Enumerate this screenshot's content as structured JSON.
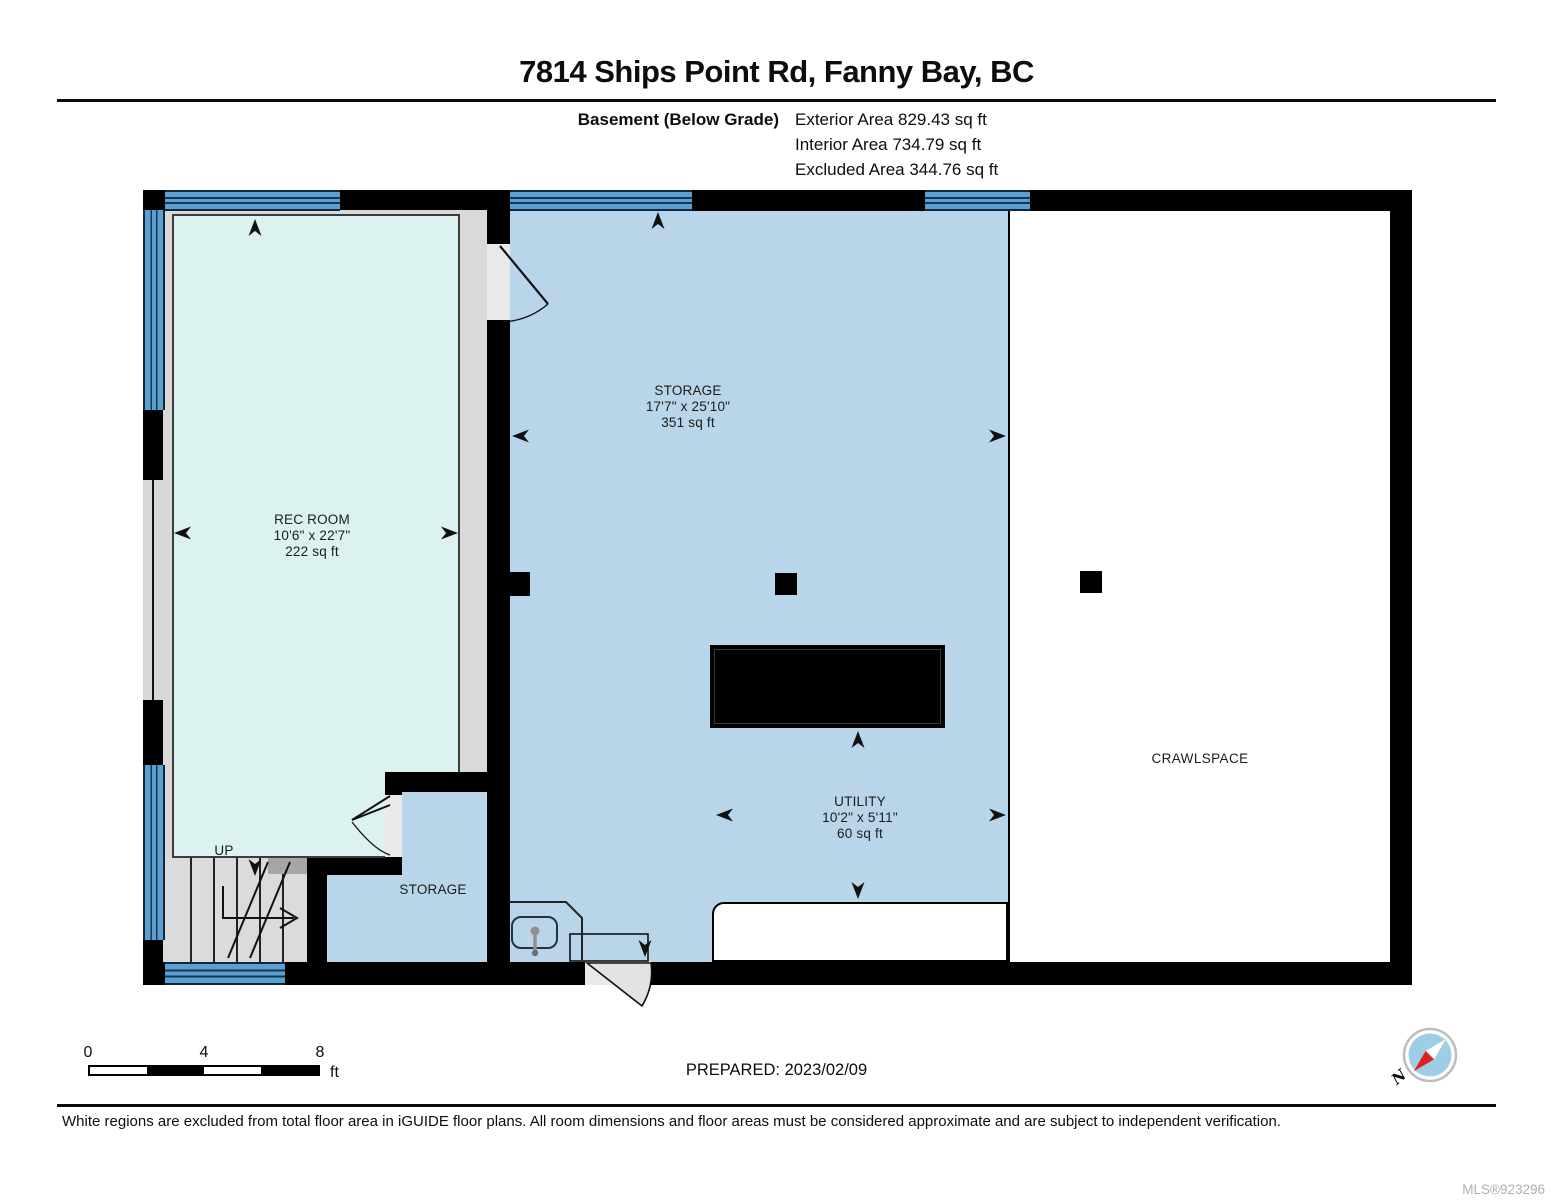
{
  "header": {
    "title": "7814 Ships Point Rd, Fanny Bay, BC",
    "floor_label": "Basement (Below Grade)",
    "exterior_area": "Exterior Area 829.43 sq ft",
    "interior_area": "Interior Area 734.79 sq ft",
    "excluded_area": "Excluded Area 344.76 sq ft"
  },
  "plan": {
    "rooms": {
      "rec_room": {
        "name": "REC ROOM",
        "dimensions": "10'6\" x 22'7\"",
        "area": "222 sq ft"
      },
      "storage": {
        "name": "STORAGE",
        "dimensions": "17'7\" x 25'10\"",
        "area": "351 sq ft"
      },
      "utility": {
        "name": "UTILITY",
        "dimensions": "10'2\" x 5'11\"",
        "area": "60 sq ft"
      },
      "storage_closet": {
        "name": "STORAGE"
      },
      "crawlspace": {
        "name": "CRAWLSPACE"
      },
      "stairs": {
        "direction_label": "UP"
      }
    }
  },
  "scale_bar": {
    "ticks": [
      "0",
      "4",
      "8"
    ],
    "unit": "ft"
  },
  "footer": {
    "prepared": "PREPARED: 2023/02/09",
    "disclaimer": "White regions are excluded from total floor area in iGUIDE floor plans. All room dimensions and floor areas must be considered approximate and are subject to independent verification.",
    "mls": "MLS®923296"
  },
  "compass": {
    "north_label": "N"
  },
  "colors": {
    "wall": "#000000",
    "window_blue": "#5B9FD3",
    "included_room_blue": "#B9D5E9",
    "rec_room_cyan": "#DCF2F1",
    "excluded_white": "#FFFFFF",
    "below_grade_gray": "#D9D9D9",
    "compass_needle_red": "#E02020"
  }
}
